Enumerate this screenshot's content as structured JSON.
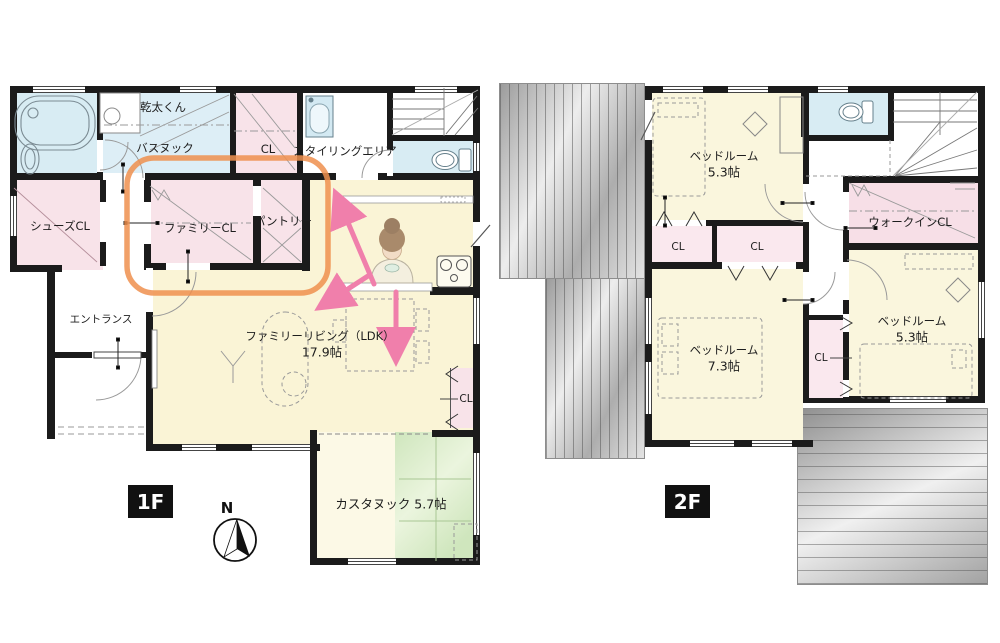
{
  "colors": {
    "wall": "#1b1b1b",
    "room_yellow": "#faf4d6",
    "room_cream": "#fcf9e6",
    "room_blue": "#d8ecf3",
    "room_pink": "#f8e3e9",
    "tatami_green": "#d9ecca",
    "balcony_gray": "#b9b9b9",
    "highlight_orange": "#ee8f4e",
    "arrow_pink": "#f07fab"
  },
  "f1": {
    "badge": "1F",
    "compass_north": "N",
    "labels": {
      "dryer": "乾太くん",
      "bath_nook": "バスヌック",
      "closet_top": "CL",
      "styling_area": "スタイリングエリア",
      "shoes_closet": "シューズCL",
      "family_closet": "ファミリーCL",
      "pantry": "パントリー",
      "entrance": "エントランス",
      "living_name": "ファミリーリビング（LDK）",
      "living_size": "17.9帖",
      "living_closet": "CL",
      "custom_nook": "カスタヌック 5.7帖"
    }
  },
  "f2": {
    "badge": "2F",
    "labels": {
      "bedroom1_name": "ベッドルーム",
      "bedroom1_size": "5.3帖",
      "closet_a": "CL",
      "closet_b": "CL",
      "walk_in_closet": "ウォークインCL",
      "bedroom2_name": "ベッドルーム",
      "bedroom2_size": "7.3帖",
      "closet_c": "CL",
      "bedroom3_name": "ベッドルーム",
      "bedroom3_size": "5.3帖"
    }
  }
}
